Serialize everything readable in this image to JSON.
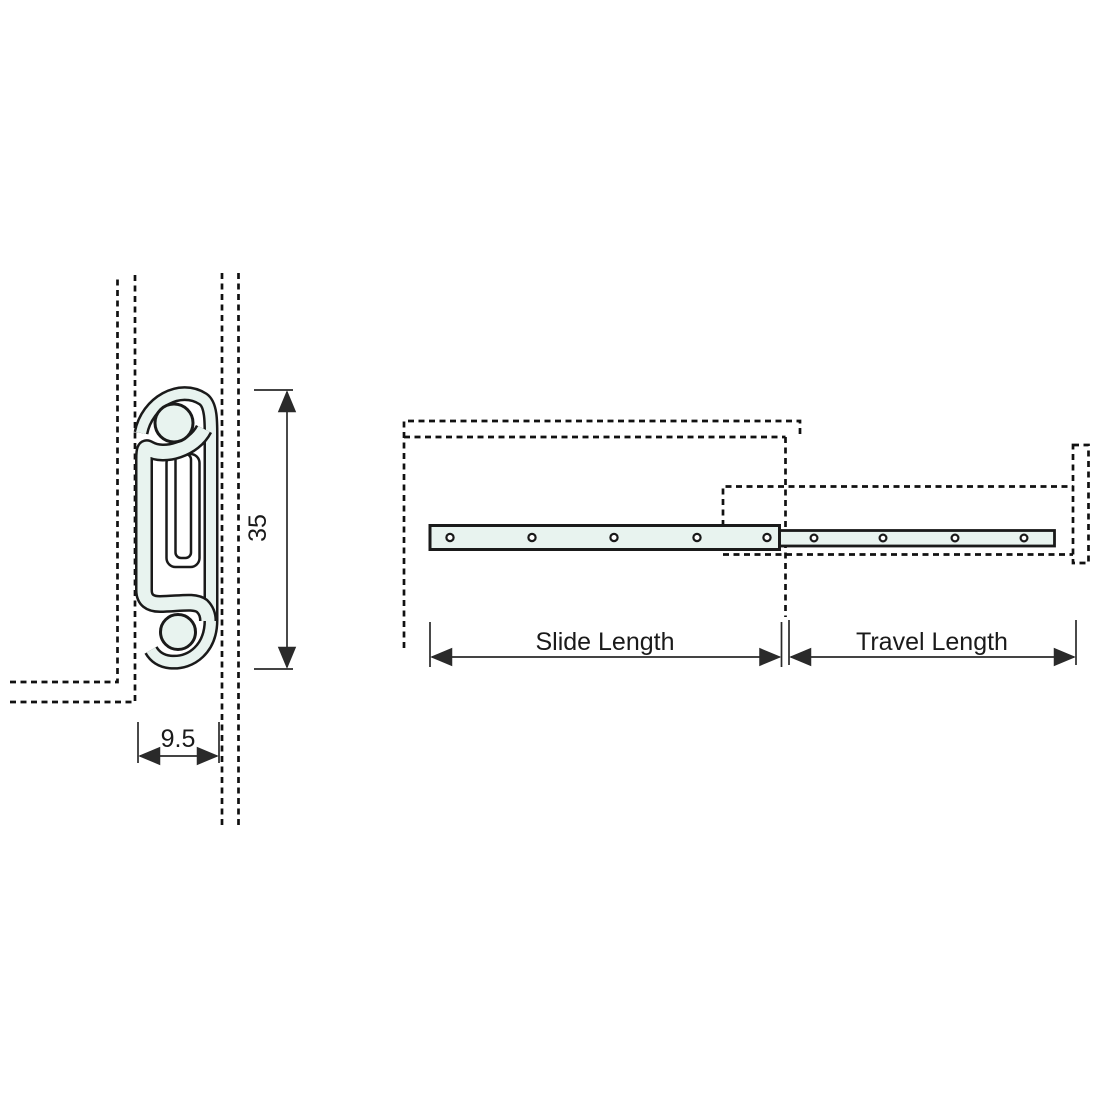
{
  "diagram_type": "drawer slide technical drawing",
  "cross_section_view": {
    "height_dimension": "35",
    "width_dimension": "9.5"
  },
  "side_view": {
    "slide_length_label": "Slide Length",
    "travel_length_label": "Travel Length",
    "slide_bar_holes": [
      450,
      532,
      614,
      697,
      767
    ],
    "slide_holes_cy": 537.5,
    "travel_bar_holes": [
      814,
      883,
      955,
      1024
    ],
    "travel_holes_cy": 538
  },
  "colors": {
    "slide_fill": "#e8f3ef",
    "outline": "#1a1a1a",
    "dashed_line": "#111111",
    "dimension_line": "#2a2a2a",
    "text": "#1a1a1a",
    "background": "#ffffff"
  }
}
